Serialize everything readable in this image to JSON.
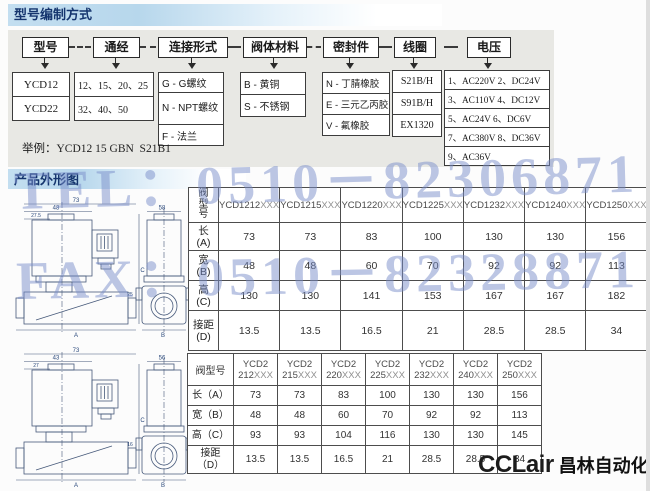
{
  "page": {
    "section1_title": "型号编制方式",
    "section2_title": "产品外形图",
    "example_label": "举例：",
    "example_value": "YCD12 15 GBN  S21B1",
    "watermark_line1": "TEL：0510－82306871",
    "watermark_line2": "FAX：0510－82328871",
    "logo_en": "CCLair",
    "logo_cn": "昌林自动化",
    "colors": {
      "header_bar_blue": "#b7d7ec",
      "title_text": "#15356e",
      "panel_gray": "#e8e8e4",
      "watermark_blue": "#7a8eca",
      "drawing_line": "#46597a"
    }
  },
  "flow": {
    "boxes": [
      "型号",
      "通经",
      "连接形式",
      "阀体材料",
      "密封件",
      "线圈",
      "电压"
    ],
    "options": {
      "model": [
        "YCD12",
        "YCD22"
      ],
      "diameter": [
        "12、15、20、25",
        "32、40、50"
      ],
      "connection": [
        "G - G螺纹",
        "N - NPT螺纹",
        "F - 法兰"
      ],
      "body_material": [
        "B - 黄铜",
        "S - 不锈钢"
      ],
      "seal": [
        "N - 丁腈橡胶",
        "E - 三元乙丙胶",
        "V - 氟橡胶"
      ],
      "coil": [
        "S21B/H",
        "S91B/H",
        "EX1320"
      ],
      "voltage": [
        "1、AC220V 2、DC24V",
        "3、AC110V 4、DC12V",
        "5、AC24V 6、DC6V",
        "7、AC380V 8、DC36V",
        "9、AC36V"
      ]
    }
  },
  "table1": {
    "corner": "阀型号",
    "models": [
      "YCD1212XXX",
      "YCD1215XXX",
      "YCD1220XXX",
      "YCD1225XXX",
      "YCD1232XXX",
      "YCD1240XXX",
      "YCD1250XXX"
    ],
    "rows": [
      {
        "label": "长",
        "sub": "(A)",
        "values": [
          73,
          73,
          83,
          100,
          130,
          130,
          156
        ]
      },
      {
        "label": "宽",
        "sub": "(B)",
        "values": [
          48,
          48,
          60,
          70,
          92,
          92,
          113
        ]
      },
      {
        "label": "高",
        "sub": "(C)",
        "values": [
          130,
          130,
          141,
          153,
          167,
          167,
          182
        ]
      },
      {
        "label": "接距",
        "sub": "(D)",
        "values": [
          13.5,
          13.5,
          16.5,
          21,
          28.5,
          28.5,
          34
        ]
      }
    ]
  },
  "table2": {
    "corner": "阀型号",
    "models": [
      [
        "YCD2",
        "212XXX"
      ],
      [
        "YCD2",
        "215XXX"
      ],
      [
        "YCD2",
        "220XXX"
      ],
      [
        "YCD2",
        "225XXX"
      ],
      [
        "YCD2",
        "232XXX"
      ],
      [
        "YCD2",
        "240XXX"
      ],
      [
        "YCD2",
        "250XXX"
      ]
    ],
    "rows": [
      {
        "label": "长（A）",
        "values": [
          73,
          73,
          83,
          100,
          130,
          130,
          156
        ]
      },
      {
        "label": "宽（B）",
        "values": [
          48,
          48,
          60,
          70,
          92,
          92,
          113
        ]
      },
      {
        "label": "高（C）",
        "values": [
          93,
          93,
          104,
          116,
          130,
          130,
          145
        ]
      },
      {
        "label": "接距",
        "sub": "（D）",
        "values": [
          13.5,
          13.5,
          16.5,
          21,
          28.5,
          28.5,
          34
        ]
      }
    ]
  },
  "drawings": {
    "top": {
      "dim_width_overall": "73",
      "dim_width_coil": "48",
      "dim_offset": "27.5",
      "dim_side_width": "58",
      "dim_height": "C",
      "dim_port": "25",
      "dim_bottom_front": "A",
      "dim_bottom_side": "B"
    },
    "bottom": {
      "dim_width_overall": "73",
      "dim_width_coil": "43",
      "dim_offset": "27",
      "dim_side_width": "56",
      "dim_height": "C",
      "dim_port": "16",
      "dim_bottom_front": "A",
      "dim_bottom_side": "B"
    }
  }
}
